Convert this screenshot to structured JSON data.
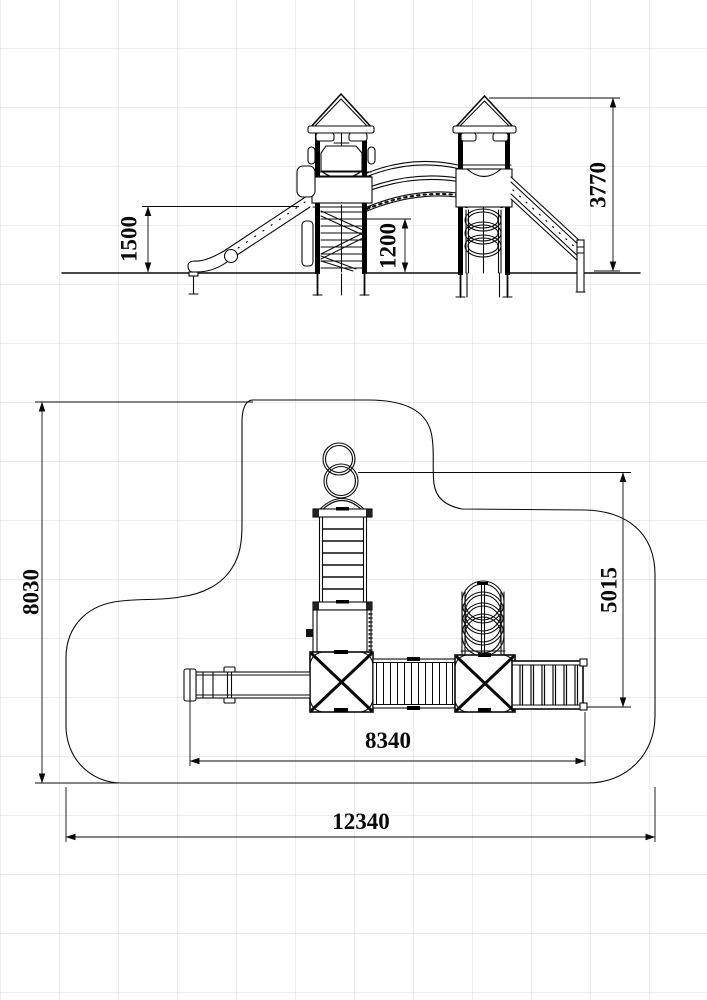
{
  "document": {
    "kind": "technical-drawing",
    "subject": "playground-equipment-installation-drawing",
    "views": {
      "elevation": {
        "label": "side-elevation",
        "dimensions": {
          "slide_platform_height": {
            "value": "1500",
            "orientation": "vertical"
          },
          "lower_deck_height": {
            "value": "1200",
            "orientation": "vertical"
          },
          "overall_height": {
            "value": "3770",
            "orientation": "vertical"
          }
        }
      },
      "plan": {
        "label": "plan-view-with-safety-zone",
        "dimensions": {
          "overall_depth": {
            "value": "8030",
            "orientation": "vertical"
          },
          "structure_depth": {
            "value": "5015",
            "orientation": "vertical"
          },
          "structure_width": {
            "value": "8340",
            "orientation": "horizontal"
          },
          "overall_width": {
            "value": "12340",
            "orientation": "horizontal"
          }
        }
      }
    },
    "style": {
      "line_color": "#0a0a0a",
      "grid_color": "#d8d8d8",
      "background": "#ffffff",
      "grid_spacing_px": 59
    }
  }
}
